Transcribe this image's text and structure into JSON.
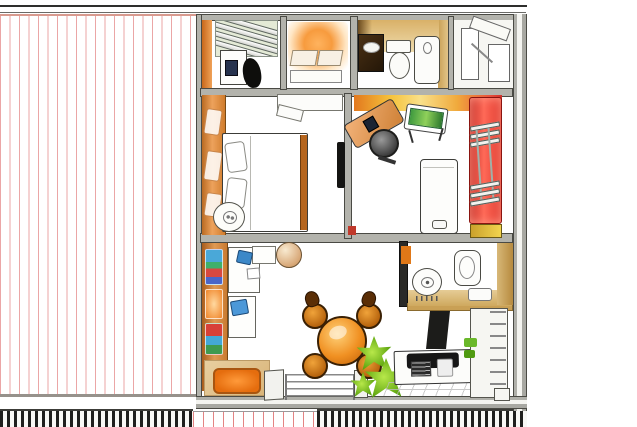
{
  "image": {
    "kind": "hand-drawn watercolor apartment floor plan, top-down axonometric",
    "visible_text": "none"
  },
  "palette": {
    "terrace_stripe_red": "#de6a6a",
    "wall_gray": "#b3b3ac",
    "outline_dark": "#3c3c38",
    "accent_orange": "#e8832a",
    "glow_orange": "#f79b3e",
    "feature_wall_red": "#e03c32",
    "wood_tan": "#d9b168",
    "plant_green": "#6ab82a",
    "poster_blue": "#4aa8d8",
    "tick_black": "#1f1f1d"
  },
  "floorplan": {
    "terrace": {
      "name": "red-striped awning terrace (left half)"
    },
    "bottom_band": {
      "name": "black tick railing band with striped middle segment"
    },
    "rooms": [
      {
        "name": "walk-in closet (top-left)",
        "furniture": [
          "louvered shelf unit",
          "white cabinet with dark screen",
          "black chair"
        ]
      },
      {
        "name": "bed nook (top-middle)",
        "furniture": [
          "glowing orange bed with two pillows"
        ]
      },
      {
        "name": "upper bathroom (top)",
        "furniture": [
          "dark vanity sink",
          "toilet",
          "shower cabin",
          "wood wall band"
        ]
      },
      {
        "name": "stair / storage corner (top-right)",
        "furniture": [
          "white stair blocks"
        ]
      },
      {
        "name": "bedroom (middle-left)",
        "furniture": [
          "orange wardrobe wall",
          "double bed with pillows and brown footboard",
          "round side table",
          "wall ledge",
          "dark door leaf"
        ]
      },
      {
        "name": "office (middle-right)",
        "furniture": [
          "angled corner desk with monitor",
          "dark office chair",
          "easel with green canvas",
          "white cabinet bed",
          "red feature wall with ladder shelves",
          "yellow step"
        ]
      },
      {
        "name": "living room (bottom-left)",
        "furniture": [
          "colorful poster wall",
          "side counters with blue chairs",
          "paper lantern ball",
          "orange flower table with four chairs",
          "sliding glass door",
          "orange rug",
          "spiky green plant"
        ]
      },
      {
        "name": "lower bathroom (bottom-right upper)",
        "furniture": [
          "toilet with tassel fringe",
          "bathtub",
          "soap dish"
        ]
      },
      {
        "name": "kitchen (bottom-right)",
        "furniture": [
          "counter with cooktop and sink",
          "tiled floor",
          "tall shelf unit with plants",
          "dark column"
        ]
      }
    ]
  }
}
